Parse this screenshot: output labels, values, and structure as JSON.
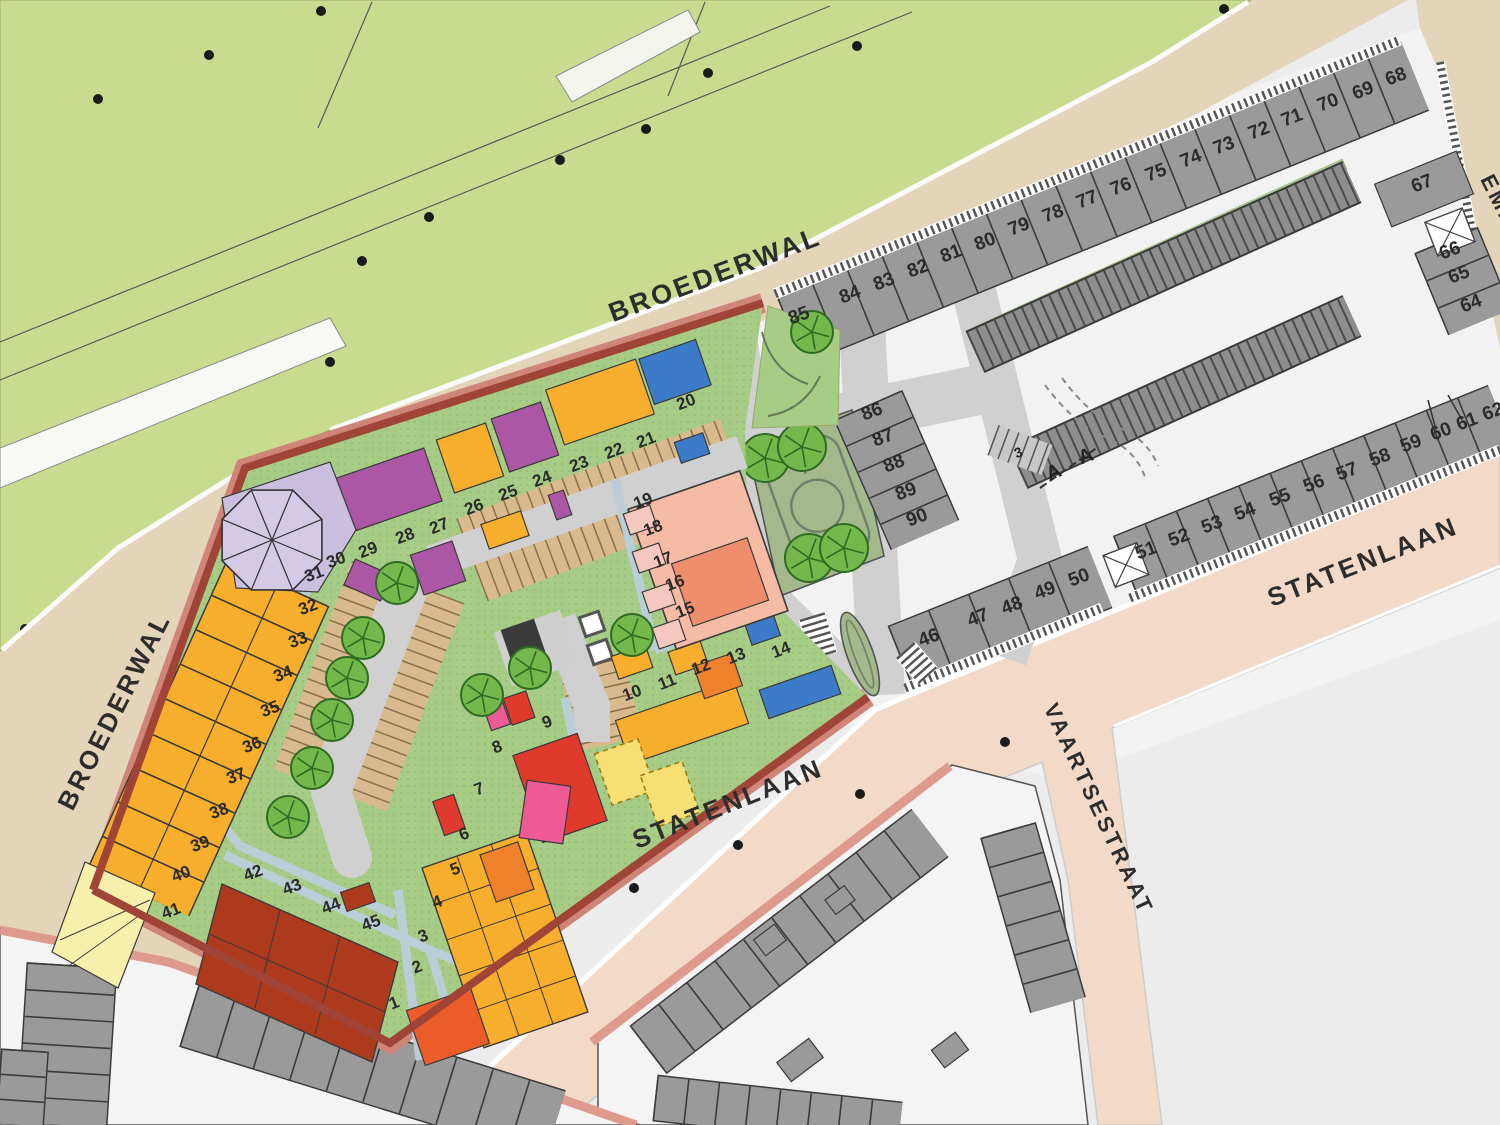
{
  "plan": {
    "type": "urban-development-site-plan",
    "streets": {
      "broederwal_top": {
        "label": "BROEDERWAL",
        "x": 718,
        "y": 283,
        "rotation": -20.5,
        "size": 27
      },
      "broederwal_left": {
        "label": "BROEDERWAL",
        "x": 122,
        "y": 715,
        "rotation": -63,
        "size": 26
      },
      "statenlaan_bottom": {
        "label": "STATENLAAN",
        "x": 731,
        "y": 812,
        "rotation": -21.5,
        "size": 26
      },
      "statenlaan_right": {
        "label": "STATENLAAN",
        "x": 1366,
        "y": 570,
        "rotation": -21.5,
        "size": 26
      },
      "vaartsestraat": {
        "label": "VAARTSESTRAAT",
        "x": 1092,
        "y": 812,
        "rotation": 65,
        "size": 22
      },
      "emmastraat_partial": {
        "label": "EMA",
        "x": 1493,
        "y": 205,
        "rotation": 63,
        "size": 22
      }
    },
    "markers": {
      "section_a": "A",
      "section_a2": "A",
      "parking_count": "3"
    },
    "plots": {
      "development": [
        {
          "n": "1",
          "x": 396,
          "y": 1008
        },
        {
          "n": "2",
          "x": 419,
          "y": 972
        },
        {
          "n": "3",
          "x": 425,
          "y": 941
        },
        {
          "n": "4",
          "x": 439,
          "y": 907
        },
        {
          "n": "5",
          "x": 457,
          "y": 874
        },
        {
          "n": "6",
          "x": 466,
          "y": 839
        },
        {
          "n": "7",
          "x": 481,
          "y": 794
        },
        {
          "n": "8",
          "x": 499,
          "y": 752
        },
        {
          "n": "9",
          "x": 549,
          "y": 727
        },
        {
          "n": "10",
          "x": 634,
          "y": 698
        },
        {
          "n": "11",
          "x": 669,
          "y": 687
        },
        {
          "n": "12",
          "x": 703,
          "y": 672
        },
        {
          "n": "13",
          "x": 738,
          "y": 661
        },
        {
          "n": "14",
          "x": 783,
          "y": 655
        },
        {
          "n": "15",
          "x": 687,
          "y": 615
        },
        {
          "n": "16",
          "x": 677,
          "y": 588
        },
        {
          "n": "17",
          "x": 665,
          "y": 565
        },
        {
          "n": "18",
          "x": 655,
          "y": 533
        },
        {
          "n": "19",
          "x": 645,
          "y": 506
        },
        {
          "n": "20",
          "x": 688,
          "y": 407
        },
        {
          "n": "21",
          "x": 648,
          "y": 445
        },
        {
          "n": "22",
          "x": 616,
          "y": 456
        },
        {
          "n": "23",
          "x": 581,
          "y": 469
        },
        {
          "n": "24",
          "x": 544,
          "y": 484
        },
        {
          "n": "25",
          "x": 510,
          "y": 498
        },
        {
          "n": "26",
          "x": 476,
          "y": 512
        },
        {
          "n": "27",
          "x": 441,
          "y": 531
        },
        {
          "n": "28",
          "x": 407,
          "y": 541
        },
        {
          "n": "29",
          "x": 370,
          "y": 555
        },
        {
          "n": "30",
          "x": 338,
          "y": 565
        },
        {
          "n": "31",
          "x": 316,
          "y": 579
        },
        {
          "n": "32",
          "x": 310,
          "y": 612
        },
        {
          "n": "33",
          "x": 300,
          "y": 645
        },
        {
          "n": "34",
          "x": 285,
          "y": 679
        },
        {
          "n": "35",
          "x": 272,
          "y": 714
        },
        {
          "n": "36",
          "x": 254,
          "y": 750
        },
        {
          "n": "37",
          "x": 238,
          "y": 781
        },
        {
          "n": "38",
          "x": 221,
          "y": 816
        },
        {
          "n": "39",
          "x": 202,
          "y": 849
        },
        {
          "n": "40",
          "x": 183,
          "y": 879
        },
        {
          "n": "41",
          "x": 173,
          "y": 916
        },
        {
          "n": "42",
          "x": 255,
          "y": 878
        },
        {
          "n": "43",
          "x": 294,
          "y": 892
        },
        {
          "n": "44",
          "x": 333,
          "y": 911
        },
        {
          "n": "45",
          "x": 373,
          "y": 928
        }
      ],
      "existing": [
        {
          "n": "46",
          "x": 931,
          "y": 643
        },
        {
          "n": "47",
          "x": 980,
          "y": 623
        },
        {
          "n": "48",
          "x": 1014,
          "y": 611
        },
        {
          "n": "49",
          "x": 1047,
          "y": 596
        },
        {
          "n": "50",
          "x": 1081,
          "y": 583
        },
        {
          "n": "51",
          "x": 1148,
          "y": 556
        },
        {
          "n": "52",
          "x": 1181,
          "y": 543
        },
        {
          "n": "53",
          "x": 1214,
          "y": 530
        },
        {
          "n": "54",
          "x": 1247,
          "y": 517
        },
        {
          "n": "55",
          "x": 1282,
          "y": 503
        },
        {
          "n": "56",
          "x": 1316,
          "y": 489
        },
        {
          "n": "57",
          "x": 1349,
          "y": 477
        },
        {
          "n": "58",
          "x": 1382,
          "y": 463
        },
        {
          "n": "59",
          "x": 1413,
          "y": 449
        },
        {
          "n": "60",
          "x": 1443,
          "y": 437
        },
        {
          "n": "61",
          "x": 1469,
          "y": 427
        },
        {
          "n": "62",
          "x": 1495,
          "y": 417
        },
        {
          "n": "64",
          "x": 1473,
          "y": 309
        },
        {
          "n": "65",
          "x": 1461,
          "y": 280
        },
        {
          "n": "66",
          "x": 1452,
          "y": 256
        },
        {
          "n": "67",
          "x": 1424,
          "y": 189
        },
        {
          "n": "68",
          "x": 1398,
          "y": 82
        },
        {
          "n": "69",
          "x": 1365,
          "y": 96
        },
        {
          "n": "70",
          "x": 1330,
          "y": 108
        },
        {
          "n": "71",
          "x": 1294,
          "y": 123
        },
        {
          "n": "72",
          "x": 1261,
          "y": 136
        },
        {
          "n": "73",
          "x": 1226,
          "y": 151
        },
        {
          "n": "74",
          "x": 1193,
          "y": 164
        },
        {
          "n": "75",
          "x": 1158,
          "y": 178
        },
        {
          "n": "76",
          "x": 1123,
          "y": 192
        },
        {
          "n": "77",
          "x": 1089,
          "y": 205
        },
        {
          "n": "78",
          "x": 1055,
          "y": 219
        },
        {
          "n": "79",
          "x": 1021,
          "y": 232
        },
        {
          "n": "80",
          "x": 987,
          "y": 247
        },
        {
          "n": "81",
          "x": 953,
          "y": 259
        },
        {
          "n": "82",
          "x": 920,
          "y": 274
        },
        {
          "n": "83",
          "x": 886,
          "y": 287
        },
        {
          "n": "84",
          "x": 852,
          "y": 300
        },
        {
          "n": "85",
          "x": 801,
          "y": 321
        },
        {
          "n": "86",
          "x": 874,
          "y": 417
        },
        {
          "n": "87",
          "x": 885,
          "y": 443
        },
        {
          "n": "88",
          "x": 896,
          "y": 469
        },
        {
          "n": "89",
          "x": 908,
          "y": 497
        },
        {
          "n": "90",
          "x": 919,
          "y": 523
        }
      ]
    },
    "colors": {
      "park": "#C9DB8E",
      "dev_green": "#A6CC85",
      "garden_green": "#A3B98C",
      "amber": "#F6AE2C",
      "orange": "#F0812B",
      "red_orange": "#EC5B2A",
      "red": "#DF3A2B",
      "dark_red": "#AE3A1E",
      "pink": "#EE5A94",
      "purple": "#AC57A5",
      "lavender": "#CBBFE0",
      "salmon_light": "#F5BBA4",
      "salmon_dark": "#EF8E6C",
      "pink_pale": "#F5C8BF",
      "blue": "#3C7BC7",
      "tan": "#D8BA8E",
      "beige_road": "#E4D4BA",
      "salmon_road": "#F3DAC8",
      "gray_road": "#D0D0D0",
      "path_blue": "#B9CED6",
      "house_gray": "#9A9A9A",
      "plot_white": "#F2F2F2",
      "curb_red": "#A04438",
      "curb_red_light": "#CF8678",
      "curb_pink": "#DE9A8D",
      "pale_yellow": "#F8DF74",
      "pale_cream": "#F6F0AC",
      "tree": "#74B84C",
      "tree_dark": "#2F6B23"
    }
  }
}
